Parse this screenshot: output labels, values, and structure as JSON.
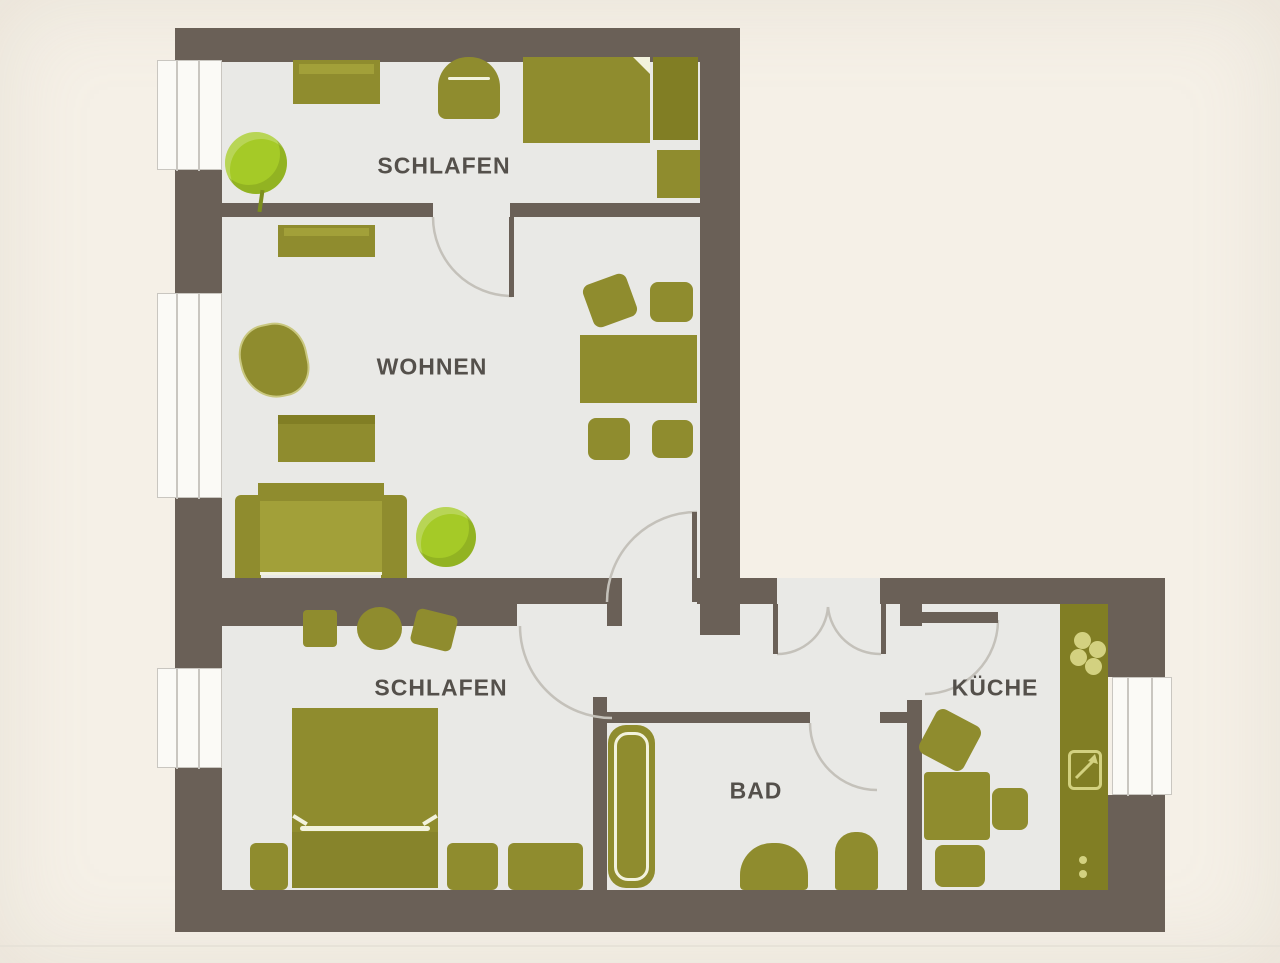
{
  "title": "Apartment floor plan",
  "palette": {
    "background": "#f5f0e7",
    "floor": "#e9e9e6",
    "wall": "#6a6057",
    "furniture": "#8f8c2e",
    "furniture-dark": "#817e24",
    "furniture-light": "#a2a039",
    "plant": "#a5ca27",
    "plant-dark": "#7d8f1f",
    "white": "#fbfaf6",
    "highlight": "#f2f2dd",
    "arc": "#c4c1ba",
    "label": "#54504b",
    "window-line": "#c9c6c0",
    "icon-light": "#d3d180"
  },
  "rooms": [
    {
      "id": "schlafen-top",
      "label": "SCHLAFEN"
    },
    {
      "id": "wohnen",
      "label": "WOHNEN"
    },
    {
      "id": "schlafen-bottom",
      "label": "SCHLAFEN"
    },
    {
      "id": "bad",
      "label": "BAD"
    },
    {
      "id": "kueche",
      "label": "KÜCHE"
    }
  ],
  "icons": [
    {
      "name": "stove-burners-icon",
      "glyph": "four-circles"
    },
    {
      "name": "sink-icon",
      "glyph": "square-with-diagonal-arrow"
    },
    {
      "name": "counter-dots-icon",
      "glyph": "two-dots"
    }
  ],
  "features": {
    "windows": 4,
    "doors": 6,
    "entrance": "double-swing"
  }
}
